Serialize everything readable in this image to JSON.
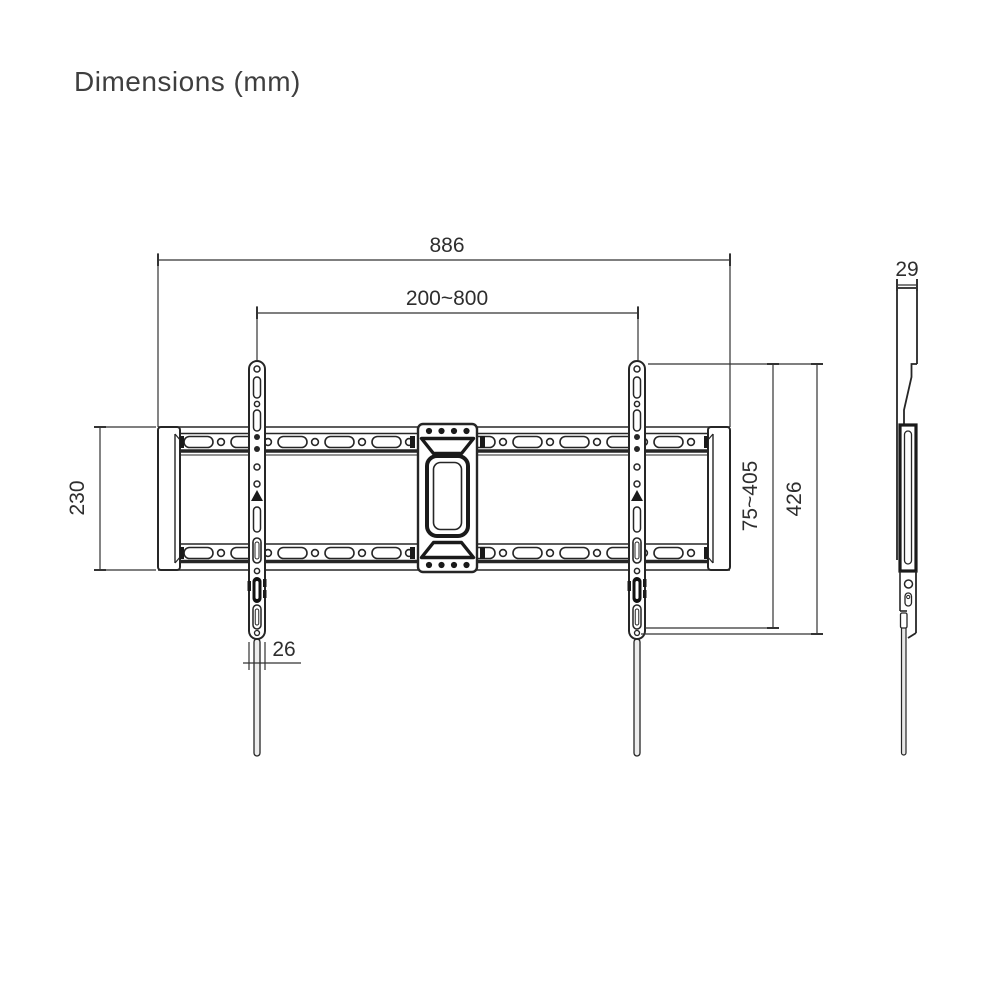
{
  "page": {
    "title": "Dimensions (mm)"
  },
  "colors": {
    "line": "#262626",
    "dimension": "#333333",
    "title_text": "#3f3f3f",
    "background": "#ffffff"
  },
  "views": {
    "front": {
      "label": "front-view-of-tv-wall-mount",
      "dimensions": {
        "overall_width": "886",
        "mount_width_range": "200~800",
        "wall_plate_height": "230",
        "strip_width": "26",
        "mount_height_range": "75~405",
        "bracket_height": "426"
      }
    },
    "side": {
      "label": "side-profile-of-tv-wall-mount",
      "dimensions": {
        "depth": "29"
      }
    }
  }
}
